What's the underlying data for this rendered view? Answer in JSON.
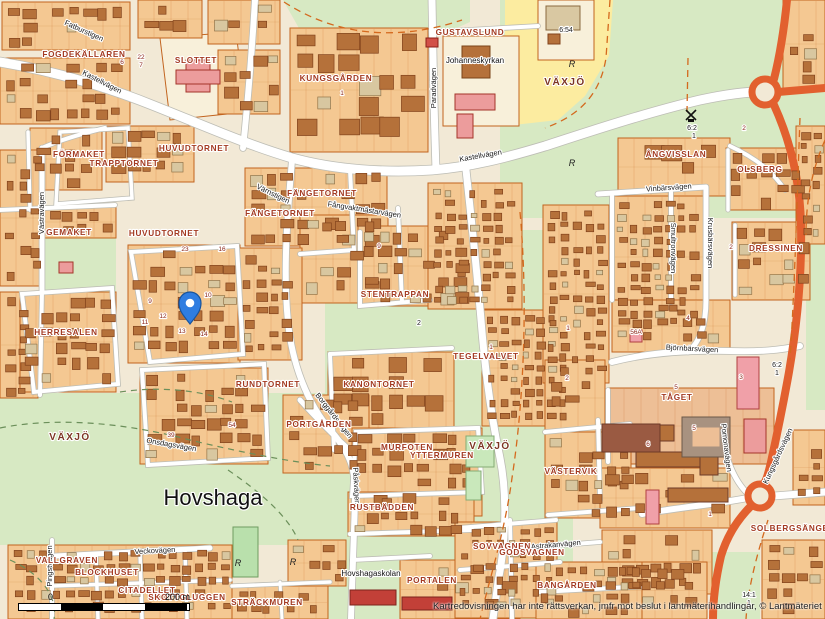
{
  "map": {
    "attribution": "Kartredovisningen har inte rättsverkan, jmfr mot beslut i lantmäterihandlingar, © Lantmäteriet",
    "scale_bar": {
      "start": "0",
      "end": "200 m"
    },
    "marker": {
      "x": 190,
      "y": 324,
      "color": "#2f7de1"
    },
    "colors": {
      "block": "#f4c892",
      "building": "#b5713a",
      "road": "#ffffff",
      "major_road": "#e2602f",
      "green": "#d7e9c3",
      "yellow": "#fceca0",
      "district_text": "#a33a22",
      "area_text": "#7c3522",
      "city_text": "#111111",
      "pin": "#2f7de1"
    },
    "city_label": {
      "text": "Hovshaga",
      "x": 213,
      "y": 505
    },
    "area_labels": [
      {
        "text": "VÄXJÖ",
        "x": 565,
        "y": 85
      },
      {
        "text": "VÄXJÖ",
        "x": 70,
        "y": 440
      },
      {
        "text": "VÄXJÖ",
        "x": 490,
        "y": 449
      }
    ],
    "district_labels": [
      {
        "text": "FOGDEKÄLLAREN",
        "x": 84,
        "y": 57
      },
      {
        "text": "SLOTTET",
        "x": 196,
        "y": 63
      },
      {
        "text": "KUNGSGÅRDEN",
        "x": 336,
        "y": 81
      },
      {
        "text": "GUSTAVSLUND",
        "x": 470,
        "y": 35
      },
      {
        "text": "FÖRMAKET",
        "x": 79,
        "y": 157
      },
      {
        "text": "TRAPPTORNET",
        "x": 124,
        "y": 166
      },
      {
        "text": "HUVUDTORNET",
        "x": 194,
        "y": 151
      },
      {
        "text": "FÄNGETORNET",
        "x": 322,
        "y": 196
      },
      {
        "text": "FÄNGETORNET",
        "x": 280,
        "y": 216
      },
      {
        "text": "GEMAKET",
        "x": 69,
        "y": 235
      },
      {
        "text": "HUVUDTORNET",
        "x": 164,
        "y": 236
      },
      {
        "text": "HERRESALEN",
        "x": 66,
        "y": 335
      },
      {
        "text": "RUNDTORNET",
        "x": 268,
        "y": 387
      },
      {
        "text": "STENTRAPPAN",
        "x": 395,
        "y": 297
      },
      {
        "text": "KANONTORNET",
        "x": 379,
        "y": 387
      },
      {
        "text": "TEGELVALVET",
        "x": 486,
        "y": 359
      },
      {
        "text": "ÅNGVISSLAN",
        "x": 676,
        "y": 157
      },
      {
        "text": "OLSBERG",
        "x": 760,
        "y": 172
      },
      {
        "text": "DRESSINEN",
        "x": 776,
        "y": 251
      },
      {
        "text": "TÅGET",
        "x": 677,
        "y": 400
      },
      {
        "text": "PORTGÅRDEN",
        "x": 319,
        "y": 427
      },
      {
        "text": "MURFOTEN",
        "x": 407,
        "y": 450
      },
      {
        "text": "YTTERMUREN",
        "x": 442,
        "y": 458
      },
      {
        "text": "RUSTBÄDDEN",
        "x": 382,
        "y": 510
      },
      {
        "text": "VALLGRAVEN",
        "x": 67,
        "y": 563
      },
      {
        "text": "BLOCKHUSET",
        "x": 107,
        "y": 575
      },
      {
        "text": "CITADELLET",
        "x": 147,
        "y": 593
      },
      {
        "text": "SKOTTGLUGGEN",
        "x": 187,
        "y": 600
      },
      {
        "text": "STRÄCKMUREN",
        "x": 267,
        "y": 605
      },
      {
        "text": "PORTALEN",
        "x": 432,
        "y": 583
      },
      {
        "text": "SOVVAGNEN",
        "x": 502,
        "y": 549
      },
      {
        "text": "GODSVAGNEN",
        "x": 532,
        "y": 555
      },
      {
        "text": "VÄSTERVIK",
        "x": 571,
        "y": 474
      },
      {
        "text": "SOLBERGSÄNGEN",
        "x": 793,
        "y": 531
      },
      {
        "text": "BANGÅRDEN",
        "x": 567,
        "y": 588
      }
    ],
    "street_labels": [
      {
        "text": "Kastellvägen",
        "x": 101,
        "y": 84,
        "rot": 27
      },
      {
        "text": "Kastellvägen",
        "x": 481,
        "y": 158,
        "rot": -10
      },
      {
        "text": "Paradvägen",
        "x": 436,
        "y": 88,
        "rot": -90
      },
      {
        "text": "Vinbärsvägen",
        "x": 669,
        "y": 190,
        "rot": -4
      },
      {
        "text": "Krusbärsvägen",
        "x": 708,
        "y": 243,
        "rot": 90
      },
      {
        "text": "Smultronvägen",
        "x": 671,
        "y": 248,
        "rot": 90
      },
      {
        "text": "Björnbärsvägen",
        "x": 692,
        "y": 351,
        "rot": 3
      },
      {
        "text": "Kungsgårdsvägen",
        "x": 780,
        "y": 457,
        "rot": -65
      },
      {
        "text": "Pomonavägen",
        "x": 724,
        "y": 448,
        "rot": 83
      },
      {
        "text": "Astrakanvägen",
        "x": 556,
        "y": 547,
        "rot": -5
      },
      {
        "text": "Veckovägen",
        "x": 155,
        "y": 553,
        "rot": -3
      },
      {
        "text": "Påskvägen",
        "x": 354,
        "y": 486,
        "rot": 87
      },
      {
        "text": "Västravägen",
        "x": 44,
        "y": 213,
        "rot": -90
      },
      {
        "text": "Värnstigen",
        "x": 272,
        "y": 196,
        "rot": 26
      },
      {
        "text": "Fångvaktmästarvägen",
        "x": 364,
        "y": 212,
        "rot": 9
      },
      {
        "text": "Borggårdsvägen",
        "x": 332,
        "y": 417,
        "rot": 52
      },
      {
        "text": "Fatburstigen",
        "x": 83,
        "y": 33,
        "rot": 24
      },
      {
        "text": "Onsdagsvägen",
        "x": 171,
        "y": 447,
        "rot": 10
      },
      {
        "text": "Pingstvägen",
        "x": 52,
        "y": 566,
        "rot": -90
      }
    ],
    "poi_labels": [
      {
        "text": "Johanneskyrkan",
        "x": 475,
        "y": 63
      },
      {
        "text": "Hovshagaskolan",
        "x": 371,
        "y": 576
      }
    ],
    "cadastral_labels": [
      {
        "text": "6:54",
        "x": 566,
        "y": 32
      },
      {
        "text": "6:2",
        "x": 692,
        "y": 130
      },
      {
        "text": "1",
        "x": 694,
        "y": 138
      },
      {
        "text": "6:2",
        "x": 777,
        "y": 367
      },
      {
        "text": "1",
        "x": 777,
        "y": 375
      },
      {
        "text": "14:1",
        "x": 749,
        "y": 597
      },
      {
        "text": "1",
        "x": 749,
        "y": 605
      },
      {
        "text": "2",
        "x": 419,
        "y": 325
      }
    ],
    "parcel_numbers": [
      {
        "text": "20",
        "x": 119,
        "y": 57
      },
      {
        "text": "6",
        "x": 122,
        "y": 64
      },
      {
        "text": "22",
        "x": 141,
        "y": 59
      },
      {
        "text": "7",
        "x": 141,
        "y": 67
      },
      {
        "text": "1",
        "x": 342,
        "y": 95
      },
      {
        "text": "9",
        "x": 379,
        "y": 248
      },
      {
        "text": "1",
        "x": 491,
        "y": 349
      },
      {
        "text": "1",
        "x": 568,
        "y": 330
      },
      {
        "text": "2",
        "x": 567,
        "y": 380
      },
      {
        "text": "4",
        "x": 688,
        "y": 320
      },
      {
        "text": "2",
        "x": 731,
        "y": 249
      },
      {
        "text": "39",
        "x": 171,
        "y": 437
      },
      {
        "text": "54",
        "x": 232,
        "y": 427
      },
      {
        "text": "56A",
        "x": 636,
        "y": 334
      },
      {
        "text": "5",
        "x": 694,
        "y": 430
      },
      {
        "text": "6",
        "x": 648,
        "y": 446
      },
      {
        "text": "1",
        "x": 710,
        "y": 516
      },
      {
        "text": "9",
        "x": 150,
        "y": 303
      },
      {
        "text": "11",
        "x": 145,
        "y": 324
      },
      {
        "text": "12",
        "x": 163,
        "y": 318
      },
      {
        "text": "13",
        "x": 182,
        "y": 333
      },
      {
        "text": "14",
        "x": 204,
        "y": 336
      },
      {
        "text": "10",
        "x": 208,
        "y": 297
      },
      {
        "text": "23",
        "x": 185,
        "y": 251
      },
      {
        "text": "16",
        "x": 222,
        "y": 251
      },
      {
        "text": "5",
        "x": 676,
        "y": 389
      },
      {
        "text": "3",
        "x": 741,
        "y": 379
      },
      {
        "text": "2",
        "x": 744,
        "y": 130
      }
    ],
    "symbols": [
      {
        "type": "rune-R",
        "x": 572,
        "y": 67
      },
      {
        "type": "rune-R",
        "x": 572,
        "y": 166
      },
      {
        "type": "rune-R",
        "x": 238,
        "y": 566
      },
      {
        "type": "rune-R",
        "x": 293,
        "y": 565
      },
      {
        "type": "windmill",
        "x": 691,
        "y": 115
      }
    ]
  }
}
